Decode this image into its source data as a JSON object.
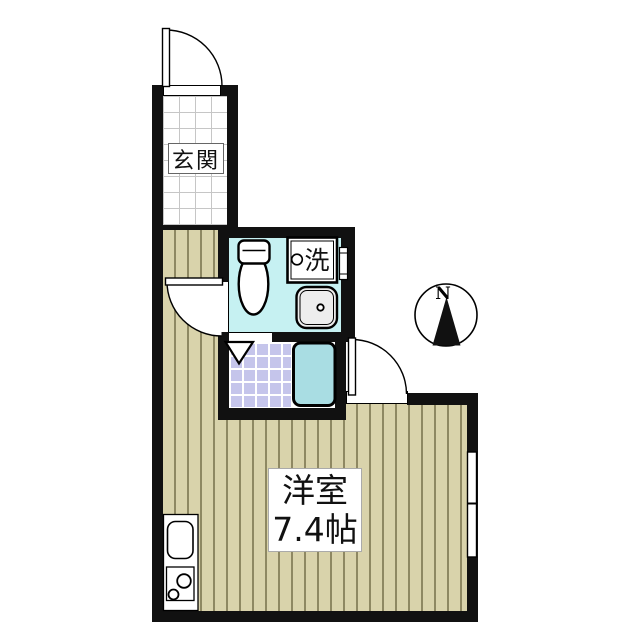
{
  "labels": {
    "entrance": "玄関",
    "washer": "洗",
    "room_name": "洋室",
    "room_size": "7.4帖",
    "compass_north": "N"
  },
  "fixtures": [
    "entrance-door",
    "toilet",
    "washing-machine-space",
    "wash-basin",
    "bathtub",
    "shower-room-door-triangle",
    "toilet-door",
    "main-room-door",
    "kitchen-sink",
    "two-burner-stove",
    "right-wall-window",
    "washroom-window",
    "compass-north-needle"
  ],
  "colors": {
    "wall": "#111111",
    "outline": "#000000",
    "wood": "#d9d3ab",
    "wood-stripe": "#8e8862",
    "wet-floor": "#c6f1f2",
    "bathtub": "#a9dde3",
    "shower-tile": "#c5c5eb",
    "fixture": "#ededed",
    "tile-line": "#c6c6c6",
    "grout": "#ffffff"
  }
}
